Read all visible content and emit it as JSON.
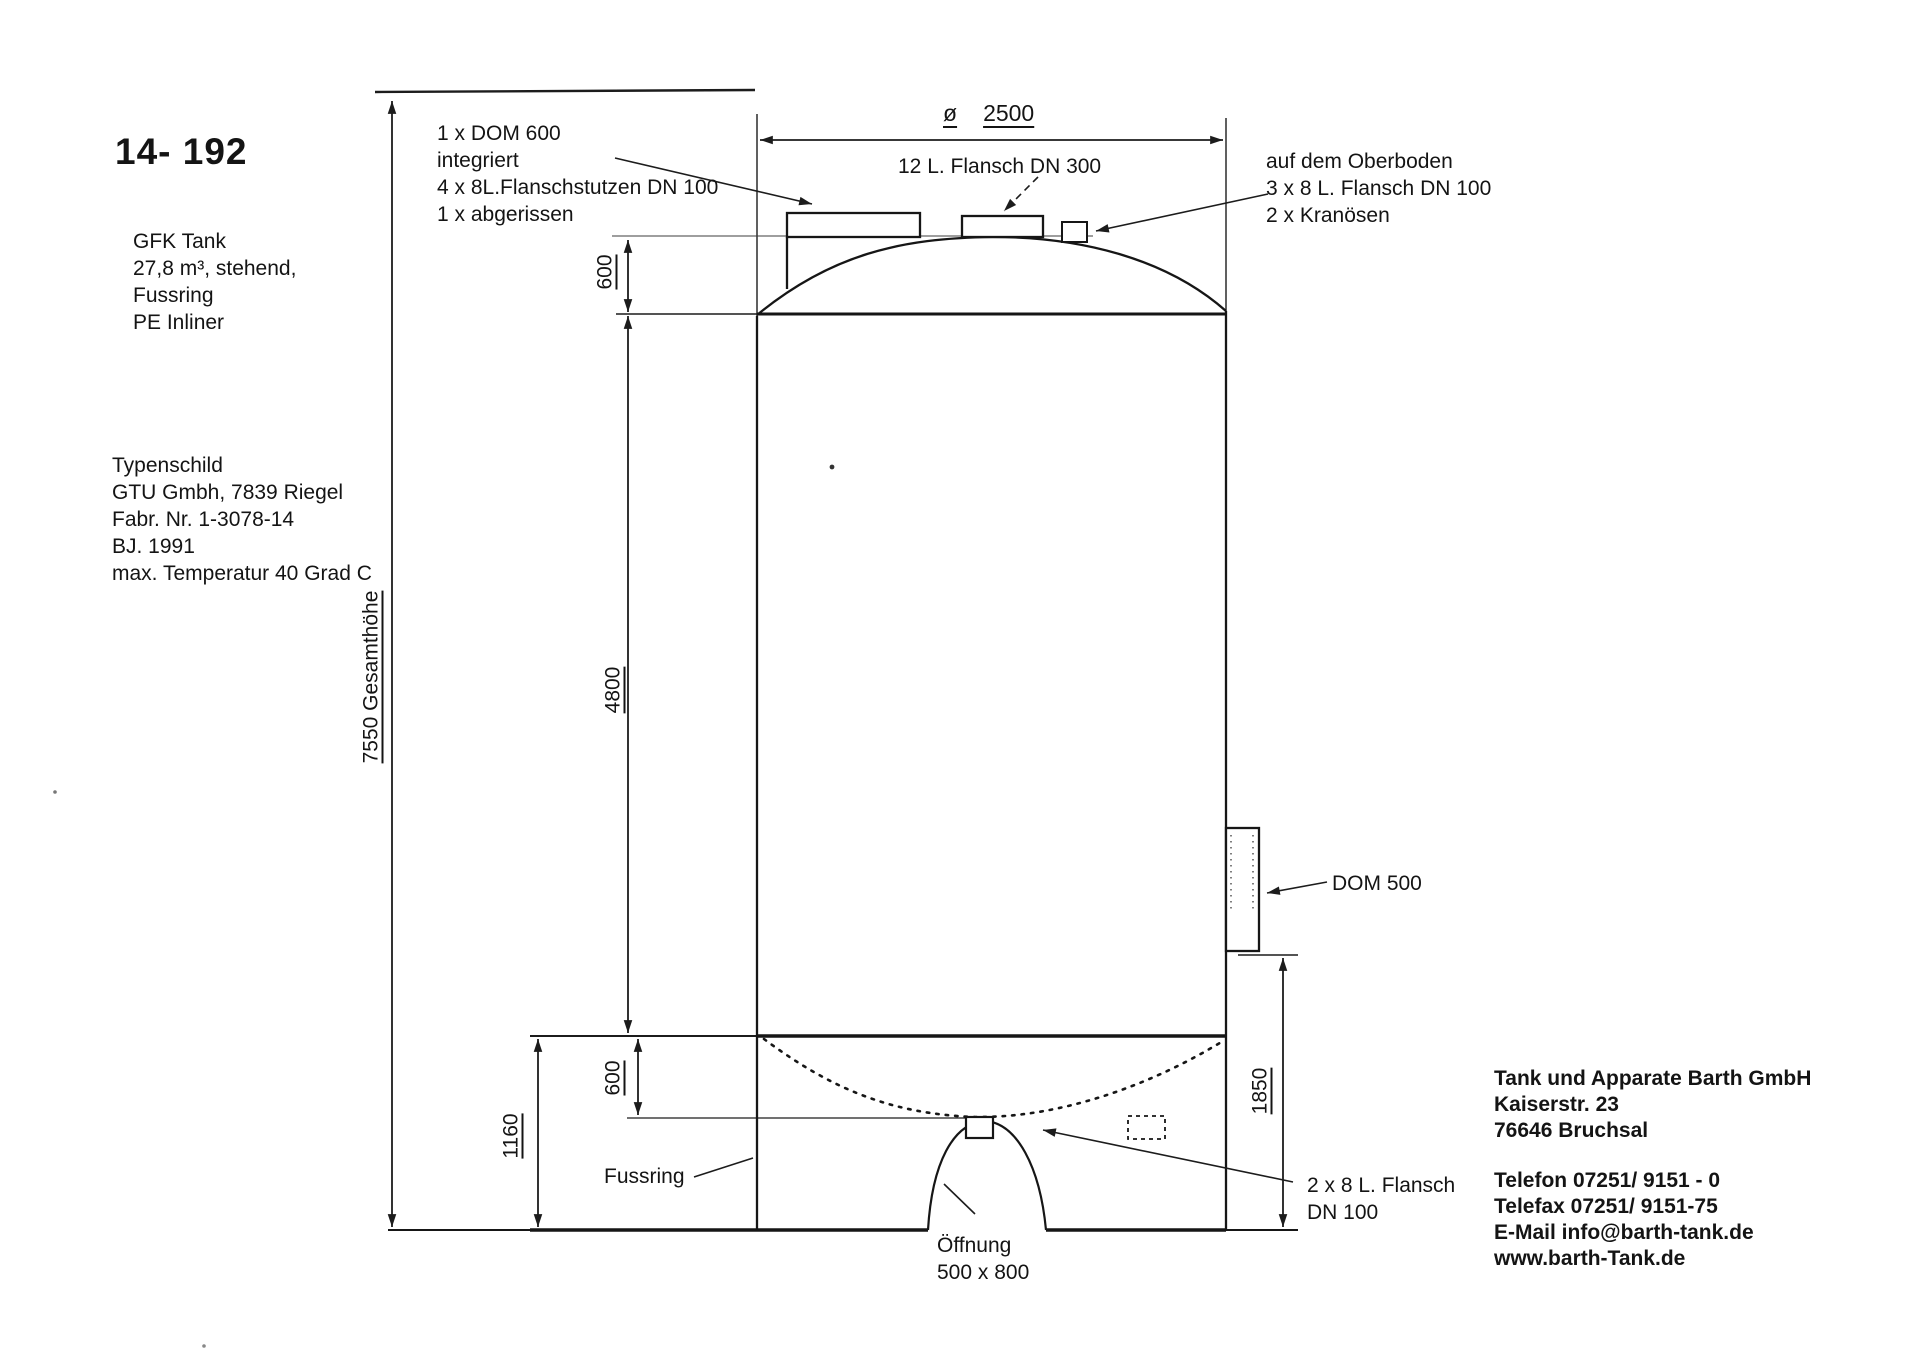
{
  "header": {
    "drawing_number": "14- 192",
    "tank_spec": [
      "GFK Tank",
      "27,8 m³, stehend,",
      "Fussring",
      "PE Inliner"
    ],
    "typenschild": [
      "Typenschild",
      "GTU Gmbh, 7839 Riegel",
      "Fabr. Nr. 1-3078-14",
      "BJ.  1991",
      "max. Temperatur  40 Grad C"
    ]
  },
  "annotations": {
    "dom600": [
      "1 x DOM 600",
      "integriert",
      "4 x 8L.Flanschstutzen DN 100",
      "1 x abgerissen"
    ],
    "flansch300": "12 L. Flansch DN 300",
    "oberboden": [
      "auf dem Oberboden",
      "3 x 8 L. Flansch DN 100",
      "2 x Kranösen"
    ],
    "dom500": "DOM 500",
    "fussring": "Fussring",
    "flansch100": [
      "2 x 8 L. Flansch",
      "DN 100"
    ],
    "oeffnung": [
      "Öffnung",
      "500 x 800"
    ]
  },
  "dimensions": {
    "diameter_symbol": "ø",
    "diameter_value": "2500",
    "total_height": "7550 Gesamthöhe",
    "dome_height": "600",
    "shell_height": "4800",
    "dish_depth": "600",
    "skirt_height": "1160",
    "dom500_height": "1850"
  },
  "company": {
    "address": [
      "Tank und Apparate Barth GmbH",
      "Kaiserstr. 23",
      "76646 Bruchsal"
    ],
    "contact": [
      "Telefon 07251/ 9151 - 0",
      "Telefax 07251/ 9151-75",
      "E-Mail info@barth-tank.de",
      "www.barth-Tank.de"
    ]
  }
}
